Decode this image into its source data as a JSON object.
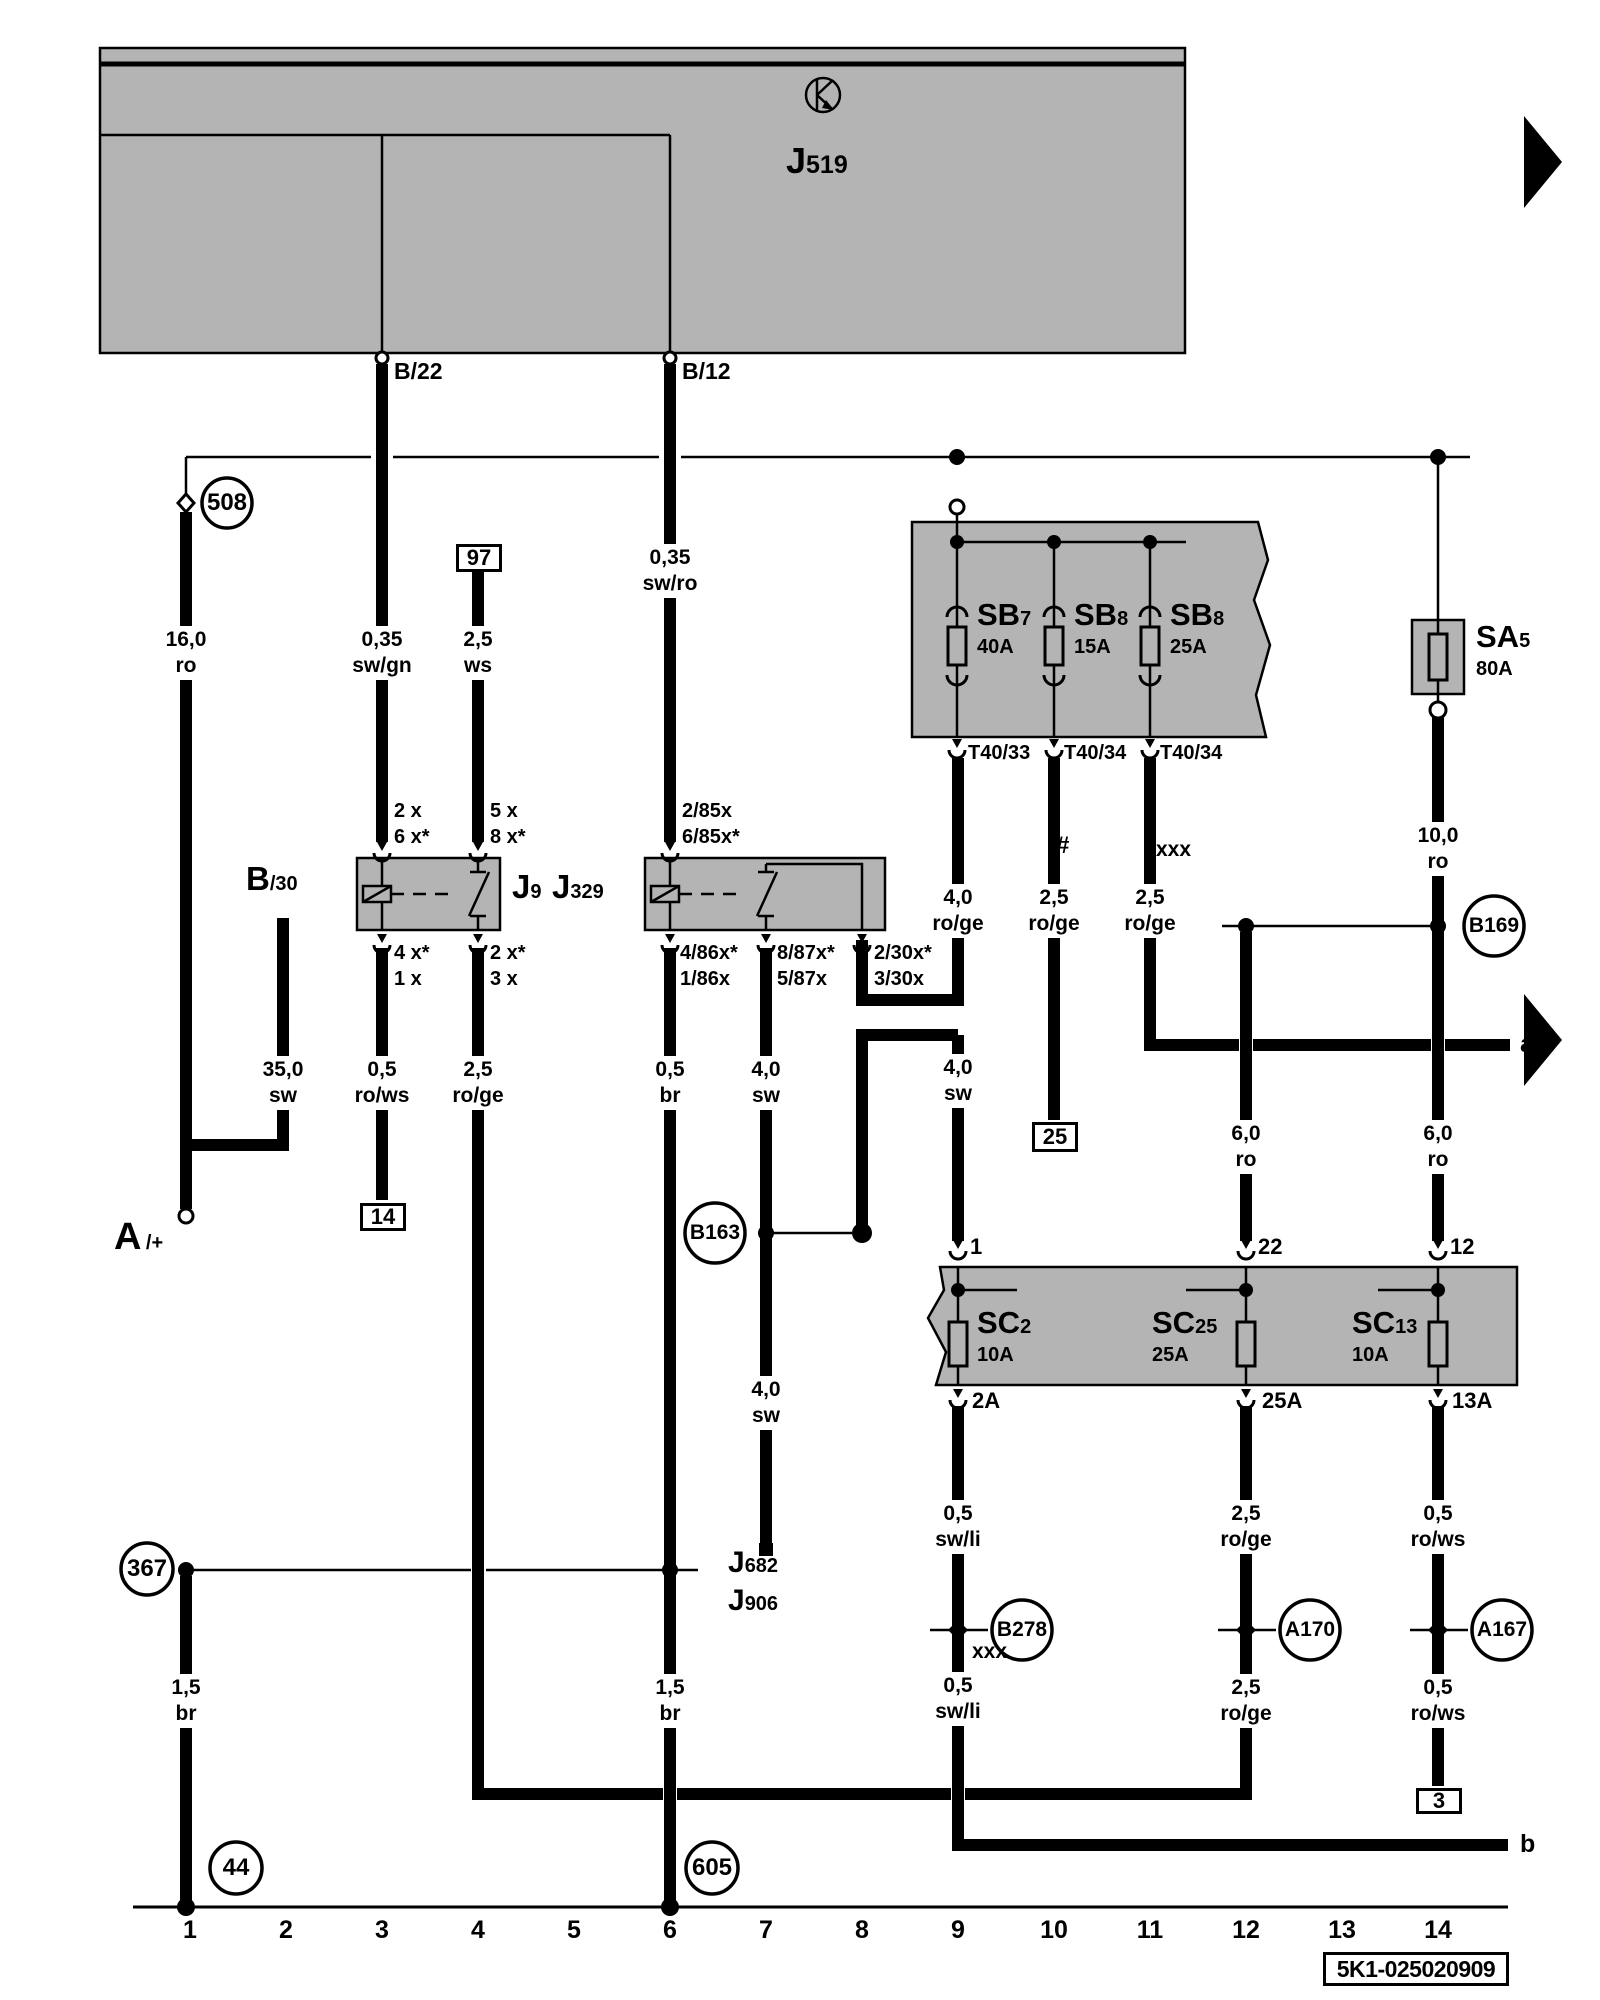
{
  "diagram": {
    "part_number": "5K1-025020909",
    "tracks": [
      "1",
      "2",
      "3",
      "4",
      "5",
      "6",
      "7",
      "8",
      "9",
      "10",
      "11",
      "12",
      "13",
      "14"
    ],
    "edge": {
      "a": "a",
      "b": "b"
    },
    "marks": {
      "hash": "#",
      "xxx_upper": "xxx",
      "xxx_lower": "xxx"
    },
    "j519": {
      "main": "J",
      "sub": "519"
    },
    "top_pins": {
      "b22": "B/22",
      "b12": "B/12"
    },
    "b30": {
      "main": "B",
      "sub": "/30"
    },
    "battery": {
      "main": "A",
      "sub": "/+"
    },
    "relays": {
      "j9": {
        "main": "J",
        "sub": "9"
      },
      "j329": {
        "main": "J",
        "sub": "329"
      },
      "j682": {
        "main": "J",
        "sub": "682"
      },
      "j906": {
        "main": "J",
        "sub": "906"
      }
    },
    "relay_pins": {
      "j9_top_left": {
        "l1": "2 x",
        "l2": "6 x*"
      },
      "j9_top_right": {
        "l1": "5 x",
        "l2": "8 x*"
      },
      "j9_bot_left": {
        "l1": "4 x*",
        "l2": "1 x"
      },
      "j9_bot_right": {
        "l1": "2 x*",
        "l2": "3 x"
      },
      "j329_top": {
        "l1": "2/85x",
        "l2": "6/85x*"
      },
      "j329_bot_1": {
        "l1": "4/86x*",
        "l2": "1/86x"
      },
      "j329_bot_2": {
        "l1": "8/87x*",
        "l2": "5/87x"
      },
      "j329_bot_3": {
        "l1": "2/30x*",
        "l2": "3/30x"
      }
    },
    "circles": {
      "c508": "508",
      "c367": "367",
      "c44": "44",
      "c605": "605",
      "b163": "B163",
      "b169": "B169",
      "b278": "B278",
      "a170": "A170",
      "a167": "A167"
    },
    "boxes": {
      "t97": "97",
      "t14": "14",
      "t25": "25",
      "t3": "3"
    },
    "fuses": {
      "sa5": {
        "main": "SA",
        "sub": "5",
        "amps": "80A"
      },
      "sb7": {
        "main": "SB",
        "sub": "7",
        "amps": "40A"
      },
      "sb8a": {
        "main": "SB",
        "sub": "8",
        "amps": "15A"
      },
      "sb8b": {
        "main": "SB",
        "sub": "8",
        "amps": "25A"
      },
      "sc2": {
        "main": "SC",
        "sub": "2",
        "amps": "10A"
      },
      "sc25": {
        "main": "SC",
        "sub": "25",
        "amps": "25A"
      },
      "sc13": {
        "main": "SC",
        "sub": "13",
        "amps": "10A"
      }
    },
    "fuse_pins": {
      "t40_33": "T40/33",
      "t40_34a": "T40/34",
      "t40_34b": "T40/34",
      "sc_in_1": "1",
      "sc_in_22": "22",
      "sc_in_12": "12",
      "sc_out_2a": "2A",
      "sc_out_25a": "25A",
      "sc_out_13a": "13A"
    },
    "wires": {
      "t1a": {
        "size": "16,0",
        "color": "ro"
      },
      "t2": {
        "size": "35,0",
        "color": "sw"
      },
      "t3a": {
        "size": "0,35",
        "color": "sw/gn"
      },
      "t3b": {
        "size": "0,5",
        "color": "ro/ws"
      },
      "t4a": {
        "size": "2,5",
        "color": "ws"
      },
      "t4b": {
        "size": "2,5",
        "color": "ro/ge"
      },
      "t6a": {
        "size": "0,35",
        "color": "sw/ro"
      },
      "t6b": {
        "size": "0,5",
        "color": "br"
      },
      "t7b": {
        "size": "4,0",
        "color": "sw"
      },
      "t8b": {
        "size": "4,0",
        "color": "sw"
      },
      "t9a": {
        "size": "4,0",
        "color": "ro/ge"
      },
      "t10a": {
        "size": "2,5",
        "color": "ro/ge"
      },
      "t11a": {
        "size": "2,5",
        "color": "ro/ge"
      },
      "t12b": {
        "size": "6,0",
        "color": "ro"
      },
      "t14a": {
        "size": "10,0",
        "color": "ro"
      },
      "t14b": {
        "size": "6,0",
        "color": "ro"
      },
      "t7c": {
        "size": "4,0",
        "color": "sw"
      },
      "t9c": {
        "size": "0,5",
        "color": "sw/li"
      },
      "t12c": {
        "size": "2,5",
        "color": "ro/ge"
      },
      "t14c": {
        "size": "0,5",
        "color": "ro/ws"
      },
      "t1d": {
        "size": "1,5",
        "color": "br"
      },
      "t6d": {
        "size": "1,5",
        "color": "br"
      },
      "t9d": {
        "size": "0,5",
        "color": "sw/li"
      },
      "t12d": {
        "size": "2,5",
        "color": "ro/ge"
      },
      "t14d": {
        "size": "0,5",
        "color": "ro/ws"
      }
    },
    "colors": {
      "panel_gray": "#b4b4b4",
      "line_black": "#000000",
      "background": "#ffffff"
    }
  }
}
